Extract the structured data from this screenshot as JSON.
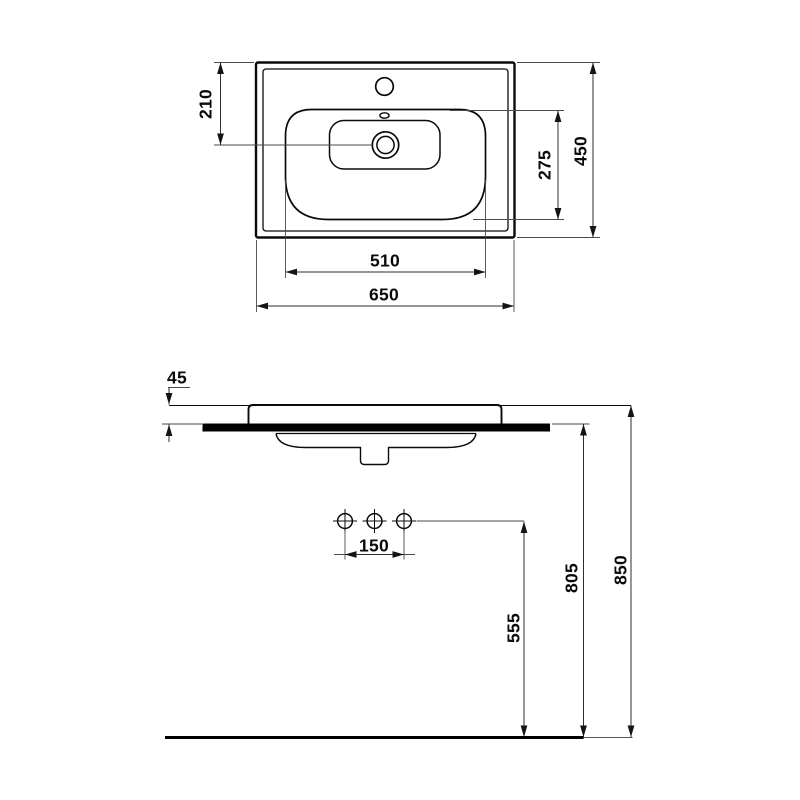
{
  "drawing": {
    "views": {
      "top": {
        "overall_width": "650",
        "overall_depth": "450",
        "bowl_width": "510",
        "bowl_depth": "275",
        "drain_offset": "210"
      },
      "front": {
        "rim_height": "45",
        "hole_spacing": "150",
        "trap_height": "555",
        "underside_height": "805",
        "total_height": "850"
      }
    },
    "colors": {
      "line": "#000000",
      "dimension_line": "#3a3a3a",
      "background": "#ffffff"
    }
  }
}
